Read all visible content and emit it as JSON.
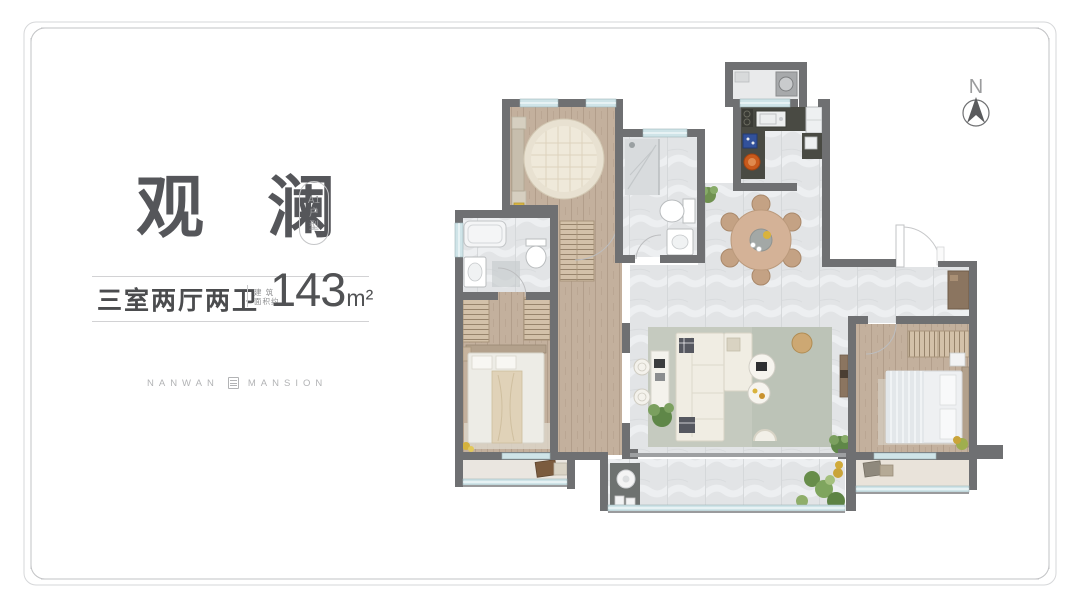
{
  "header": {
    "title": "观 澜",
    "tag": {
      "model": "A1",
      "type_char_1": "户",
      "type_char_2": "型"
    }
  },
  "specs": {
    "layout": "三室两厅两卫",
    "area_note_line_1": "建 筑",
    "area_note_line_2": "面积约",
    "area_value": "143",
    "area_unit": "m²"
  },
  "brand": {
    "word_left": "NANWAN",
    "word_right": "MANSION"
  },
  "compass": {
    "label": "N"
  },
  "colors": {
    "wall": "#6f7072",
    "marble_floor": "#e2e4e6",
    "wood_floor": "#c3b09d",
    "window_glass": "#cfe4e8",
    "kitchen_counter": "#494a43",
    "rug_green": "#bcc3b7",
    "title_text": "#55565a",
    "spec_text": "#4b4c4e",
    "area_text": "#515254",
    "muted_text": "#b2b3b5"
  }
}
